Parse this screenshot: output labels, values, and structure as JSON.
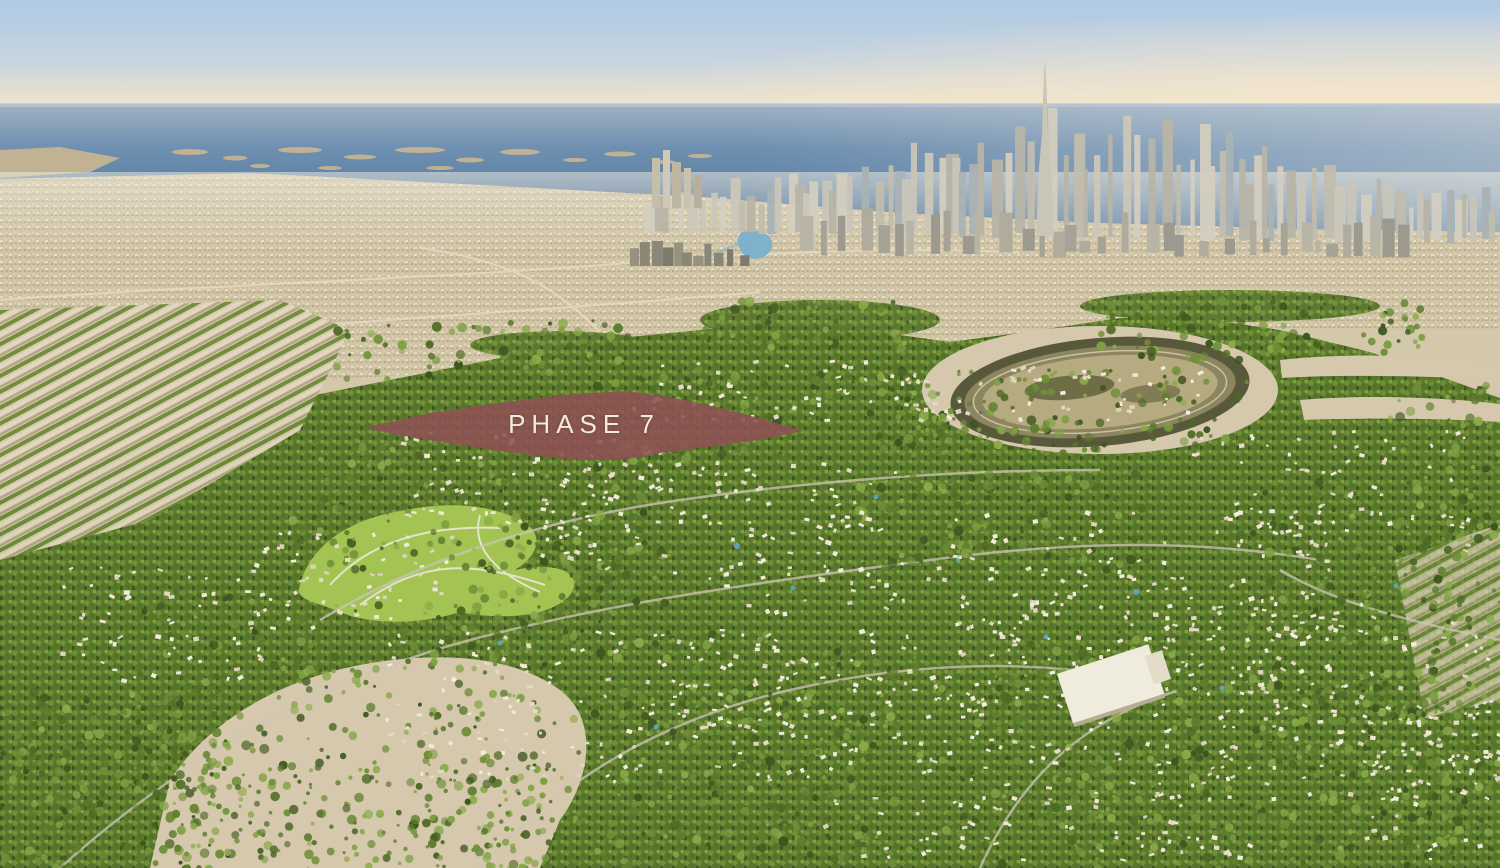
{
  "overlay": {
    "phase_label": "PHASE 7",
    "fill_color": "#8E5154",
    "label_color": "#F1EBDC"
  },
  "palette": {
    "sky_top": "#AFC9E4",
    "sky_horizon": "#EFE7D4",
    "sea_deep": "#4B7199",
    "sand": "#D4C7AA",
    "community_green": "#60802E"
  }
}
